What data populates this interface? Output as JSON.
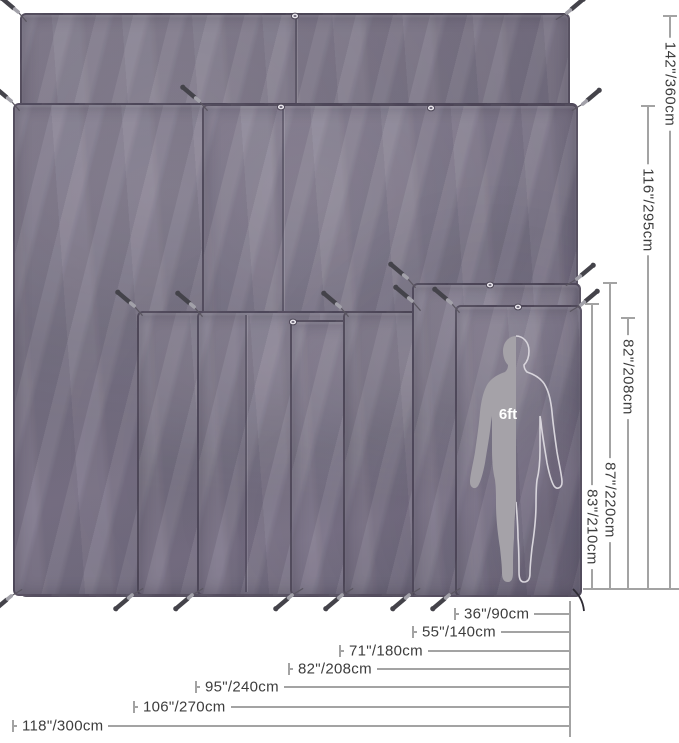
{
  "diagram": {
    "title": "tarp-footprint-size-comparison",
    "figure": {
      "scale_label": "6ft"
    },
    "colors": {
      "fabric": "#756f80",
      "fabric_edge": "#453f52",
      "dim_line": "#a3a3a3",
      "dim_text": "#3d3d3d",
      "stake_dark": "#44434a",
      "stake_light": "#a2a1a9",
      "cord": "#5a5660",
      "figure_fill": "#a5a2a8",
      "figure_outline": "#d8d5dc",
      "grommet_ring": "#4e4858",
      "grommet_face": "#ece9ef"
    },
    "tarps": [
      {
        "name": "tarp-layer-142in-tall",
        "left": 20,
        "top": 13,
        "right": 566,
        "bottom": 593,
        "seams": [
          293
        ]
      },
      {
        "name": "tarp-layer-116in-tall",
        "left": 13,
        "top": 103,
        "right": 574,
        "bottom": 592,
        "seams": []
      },
      {
        "name": "tarp-layer-inner",
        "left": 202,
        "top": 104,
        "right": 574,
        "bottom": 592,
        "seams": [
          280
        ]
      },
      {
        "name": "tarp-layer-106in-wide",
        "left": 137,
        "top": 311,
        "right": 573,
        "bottom": 592,
        "seams": []
      },
      {
        "name": "tarp-layer-95in-wide",
        "left": 197,
        "top": 311,
        "right": 573,
        "bottom": 592,
        "seams": [
          243
        ]
      },
      {
        "name": "tarp-layer-82in-wide",
        "left": 290,
        "top": 320,
        "right": 573,
        "bottom": 592,
        "seams": []
      },
      {
        "name": "tarp-layer-71in-wide",
        "left": 343,
        "top": 311,
        "right": 573,
        "bottom": 592,
        "seams": []
      },
      {
        "name": "tarp-layer-55in-wide",
        "left": 412,
        "top": 283,
        "right": 577,
        "bottom": 593,
        "seams": []
      },
      {
        "name": "tarp-layer-36in-wide",
        "left": 455,
        "top": 305,
        "right": 578,
        "bottom": 593,
        "seams": []
      }
    ],
    "height_dimensions": {
      "baseline_y": 589,
      "baseline_x_start": 583,
      "baseline_x_end": 679,
      "items": [
        {
          "label": "142\"/360cm",
          "x": 670,
          "tick_y": 16,
          "label_center": 84
        },
        {
          "label": "116\"/295cm",
          "x": 648,
          "tick_y": 106,
          "label_center": 210
        },
        {
          "label": "82\"/208cm",
          "x": 628,
          "tick_y": 318,
          "label_center": 377
        },
        {
          "label": "87\"/220cm",
          "x": 610,
          "tick_y": 283,
          "label_center": 500
        },
        {
          "label": "83\"/210cm",
          "x": 592,
          "tick_y": 304,
          "label_center": 527
        }
      ]
    },
    "width_dimensions": {
      "line_x": 570,
      "line_y_start": 601,
      "line_y_end": 737,
      "items": [
        {
          "label": "36\"/90cm",
          "y": 614,
          "tick_x": 455
        },
        {
          "label": "55\"/140cm",
          "y": 632,
          "tick_x": 413
        },
        {
          "label": "71\"/180cm",
          "y": 651,
          "tick_x": 340
        },
        {
          "label": "82\"/208cm",
          "y": 669,
          "tick_x": 289
        },
        {
          "label": "95\"/240cm",
          "y": 687,
          "tick_x": 196
        },
        {
          "label": "106\"/270cm",
          "y": 707,
          "tick_x": 134
        },
        {
          "label": "118\"/300cm",
          "y": 726,
          "tick_x": 13
        }
      ]
    },
    "stakes": [
      {
        "x": 11,
        "y": 6,
        "angle": 40
      },
      {
        "x": 574,
        "y": 7,
        "angle": 140
      },
      {
        "x": 4,
        "y": 95,
        "angle": 40
      },
      {
        "x": 192,
        "y": 95,
        "angle": 40
      },
      {
        "x": 590,
        "y": 98,
        "angle": 140
      },
      {
        "x": 127,
        "y": 300,
        "angle": 40
      },
      {
        "x": 187,
        "y": 301,
        "angle": 40
      },
      {
        "x": 333,
        "y": 301,
        "angle": 40
      },
      {
        "x": 400,
        "y": 272,
        "angle": 40
      },
      {
        "x": 405,
        "y": 295,
        "angle": 40
      },
      {
        "x": 444,
        "y": 297,
        "angle": 40
      },
      {
        "x": 584,
        "y": 273,
        "angle": 140
      },
      {
        "x": 588,
        "y": 299,
        "angle": 140
      },
      {
        "x": 4,
        "y": 602,
        "angle": -40
      },
      {
        "x": 125,
        "y": 601,
        "angle": -40
      },
      {
        "x": 185,
        "y": 601,
        "angle": -40
      },
      {
        "x": 285,
        "y": 601,
        "angle": -40
      },
      {
        "x": 335,
        "y": 601,
        "angle": -40
      },
      {
        "x": 402,
        "y": 601,
        "angle": -40
      },
      {
        "x": 442,
        "y": 601,
        "angle": -40
      }
    ],
    "grommets": [
      {
        "x": 295,
        "y": 16
      },
      {
        "x": 281,
        "y": 107
      },
      {
        "x": 431,
        "y": 108
      },
      {
        "x": 490,
        "y": 285
      },
      {
        "x": 518,
        "y": 307
      },
      {
        "x": 293,
        "y": 322
      }
    ],
    "corner_cord": {
      "path": "M573,589 C578,594 583,600 584,611"
    }
  }
}
